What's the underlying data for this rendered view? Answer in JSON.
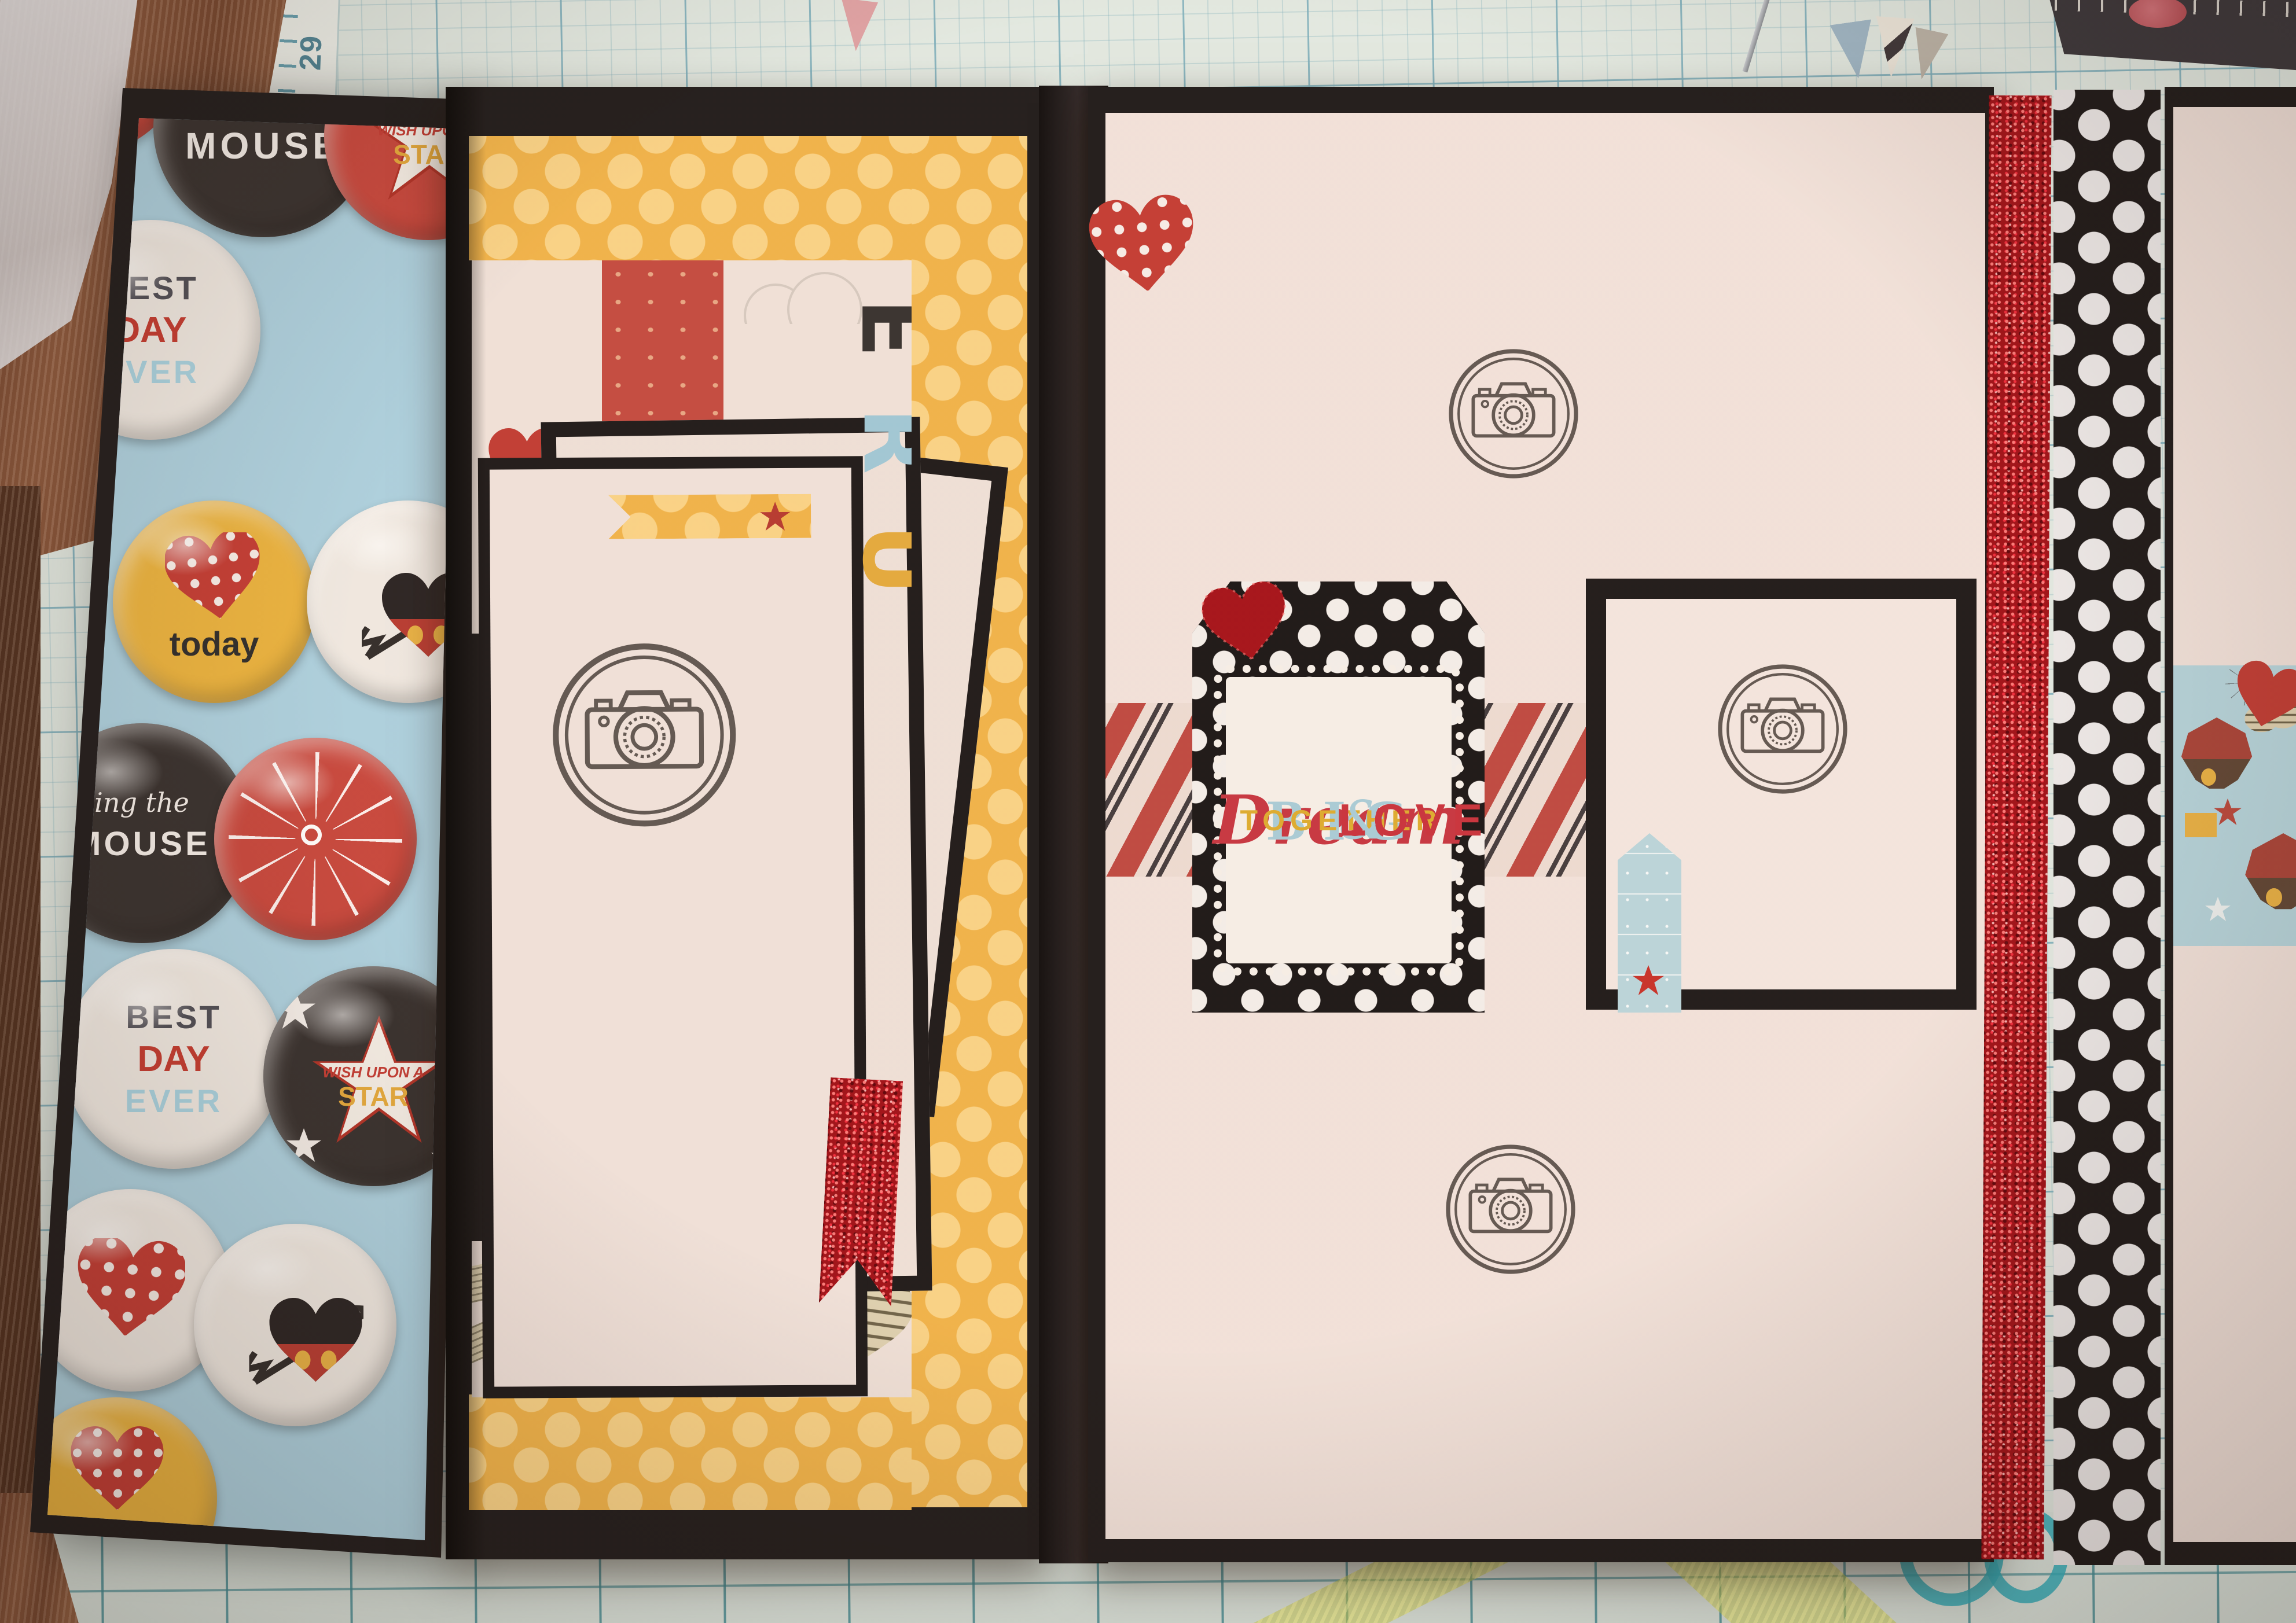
{
  "left_flap": {
    "badges": {
      "mouse": {
        "label": "MOUSE"
      },
      "wish_red": {
        "line1": "WISH UPON A",
        "line2": "STAR"
      },
      "best_day_top": {
        "line1": "BEST",
        "line2": "DAY",
        "line3": "EVER"
      },
      "today": {
        "label": "today"
      },
      "ing_mouse": {
        "line1": "ing the",
        "line2": "MOUSE"
      },
      "best_day_bottom": {
        "line1": "BEST",
        "line2": "DAY",
        "line3": "EVER"
      },
      "wish_black": {
        "line1": "WISH UPON A",
        "line2": "STAR"
      },
      "today_bottom": {
        "label": "today"
      }
    }
  },
  "dream_tag": {
    "word1": "Dream",
    "word2": "BIG",
    "word3": "TOGETHER",
    "amp": "&",
    "word4": "LOVE"
  },
  "pocket_letters": {
    "l1": "E",
    "l2": "R",
    "l3": "U"
  },
  "mat_ruler": {
    "num_top": "29",
    "num_bottom": "28"
  },
  "colors": {
    "album_black": "#1b1819",
    "cream_card": "#f2e4de",
    "polka_yellow": "#f0b349",
    "badge_blue_paper": "#abd1e1",
    "accent_red": "#c0392f",
    "glitter_red": "#9e0e16",
    "dot_strip_black": "#191617",
    "mat_teal": "#e3ebe6",
    "stamp_ink": "#4a423e"
  }
}
